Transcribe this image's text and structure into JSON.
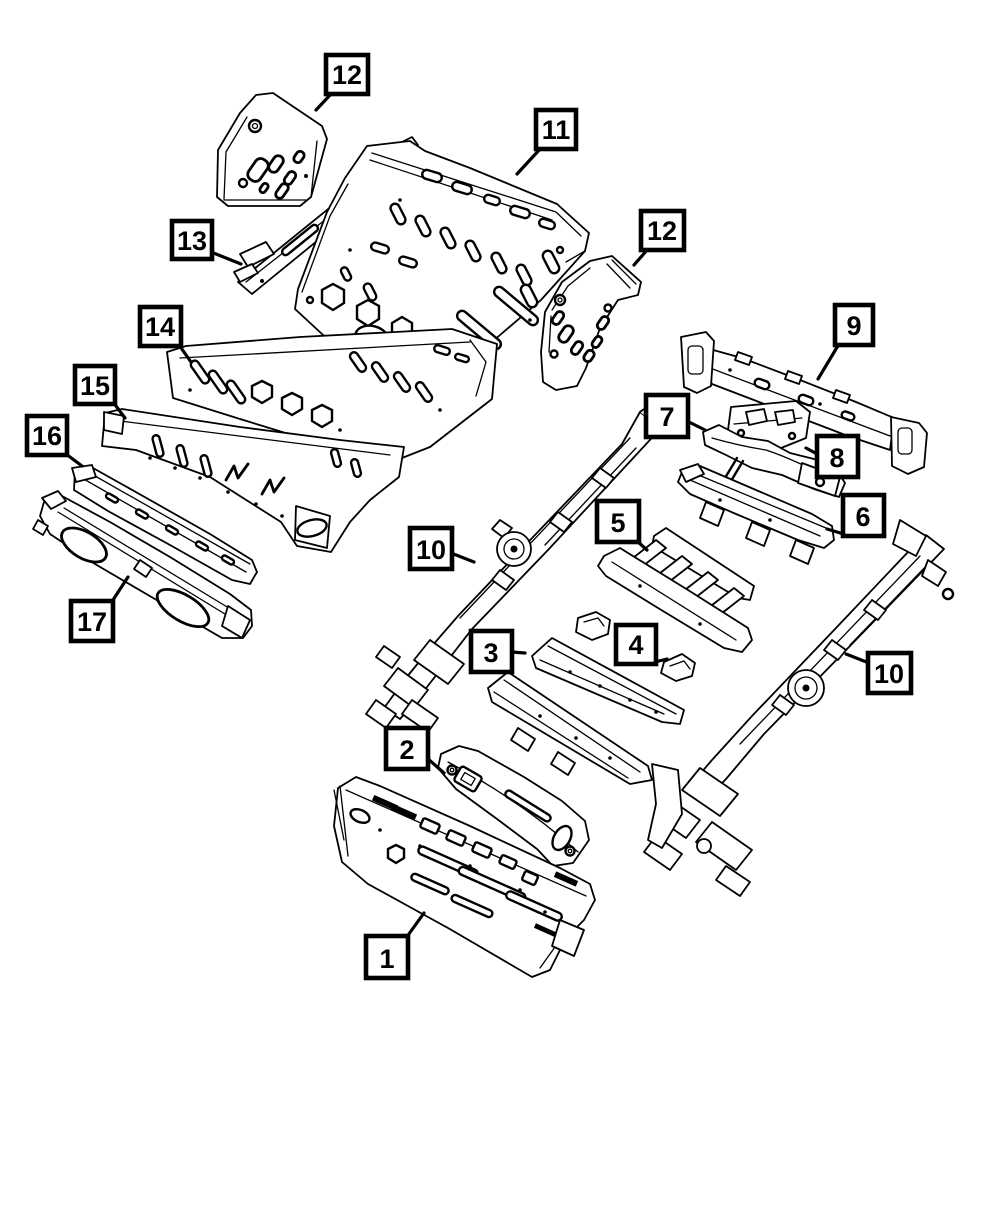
{
  "page": {
    "background_color": "#ffffff",
    "line_color": "#000000",
    "description_kind": "exploded-parts-line-diagram"
  },
  "callout_style": {
    "box_fill": "#ffffff",
    "box_border_color": "#000000",
    "number_color": "#000000"
  },
  "diagram": {
    "callouts": [
      {
        "id": "callout-12-left",
        "label": "12"
      },
      {
        "id": "callout-11",
        "label": "11"
      },
      {
        "id": "callout-13",
        "label": "13"
      },
      {
        "id": "callout-12-right",
        "label": "12"
      },
      {
        "id": "callout-14",
        "label": "14"
      },
      {
        "id": "callout-9",
        "label": "9"
      },
      {
        "id": "callout-15",
        "label": "15"
      },
      {
        "id": "callout-7",
        "label": "7"
      },
      {
        "id": "callout-16",
        "label": "16"
      },
      {
        "id": "callout-8",
        "label": "8"
      },
      {
        "id": "callout-5",
        "label": "5"
      },
      {
        "id": "callout-6",
        "label": "6"
      },
      {
        "id": "callout-10-left",
        "label": "10"
      },
      {
        "id": "callout-17",
        "label": "17"
      },
      {
        "id": "callout-3",
        "label": "3"
      },
      {
        "id": "callout-4",
        "label": "4"
      },
      {
        "id": "callout-10-right",
        "label": "10"
      },
      {
        "id": "callout-2",
        "label": "2"
      },
      {
        "id": "callout-1",
        "label": "1"
      }
    ]
  }
}
